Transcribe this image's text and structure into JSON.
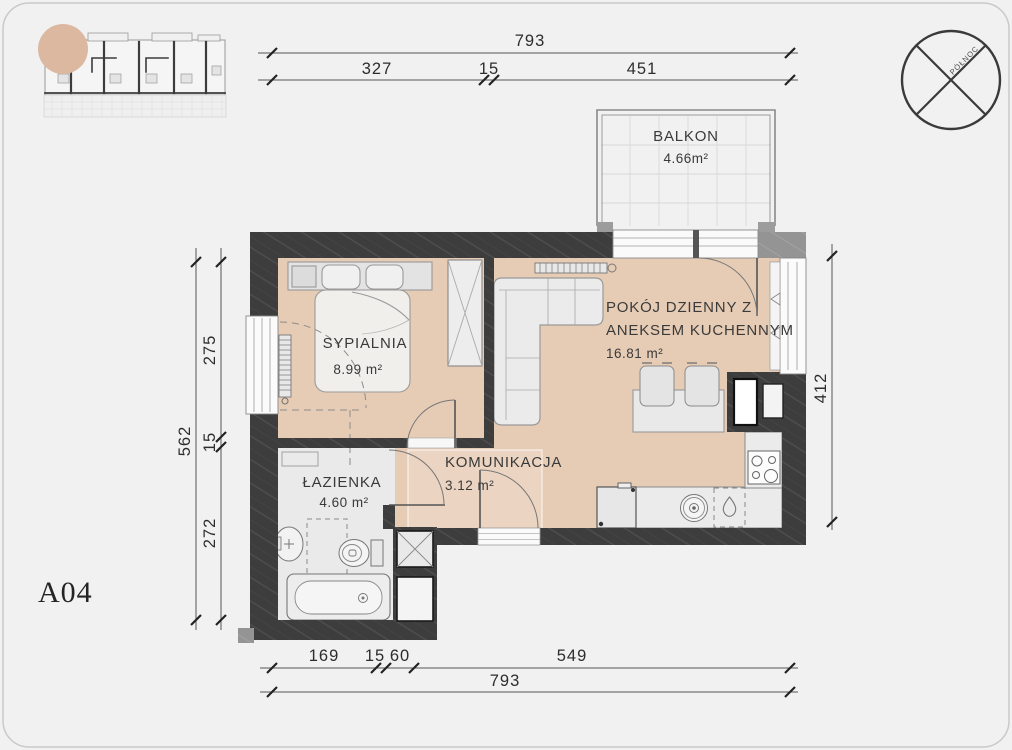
{
  "title_code": "A04",
  "compass": {
    "label": "PÓŁNOC"
  },
  "rooms": {
    "balkon": {
      "name": "BALKON",
      "area": "4.66m²"
    },
    "living": {
      "name_line1": "POKÓJ DZIENNY Z",
      "name_line2": "ANEKSEM KUCHENNYM",
      "area": "16.81 m²"
    },
    "sypialnia": {
      "name": "SYPIALNIA",
      "area": "8.99 m²"
    },
    "komunikacja": {
      "name": "KOMUNIKACJA",
      "area": "3.12 m²"
    },
    "lazienka": {
      "name": "ŁAZIENKA",
      "area": "4.60 m²"
    }
  },
  "dimensions": {
    "top": {
      "total": "793",
      "segments": [
        "327",
        "15",
        "451"
      ]
    },
    "bottom": {
      "total": "793",
      "segments": [
        "169",
        "15",
        "60",
        "549"
      ]
    },
    "left": {
      "total": "562",
      "segments": [
        "275",
        "15",
        "272"
      ]
    },
    "right": {
      "total": "412"
    }
  },
  "colors": {
    "floor_tan": "#e7ccb5",
    "wall_dark": "#3d3d3d",
    "highlight_circle": "#dcb8a0",
    "bath_floor": "#eaeaea"
  }
}
